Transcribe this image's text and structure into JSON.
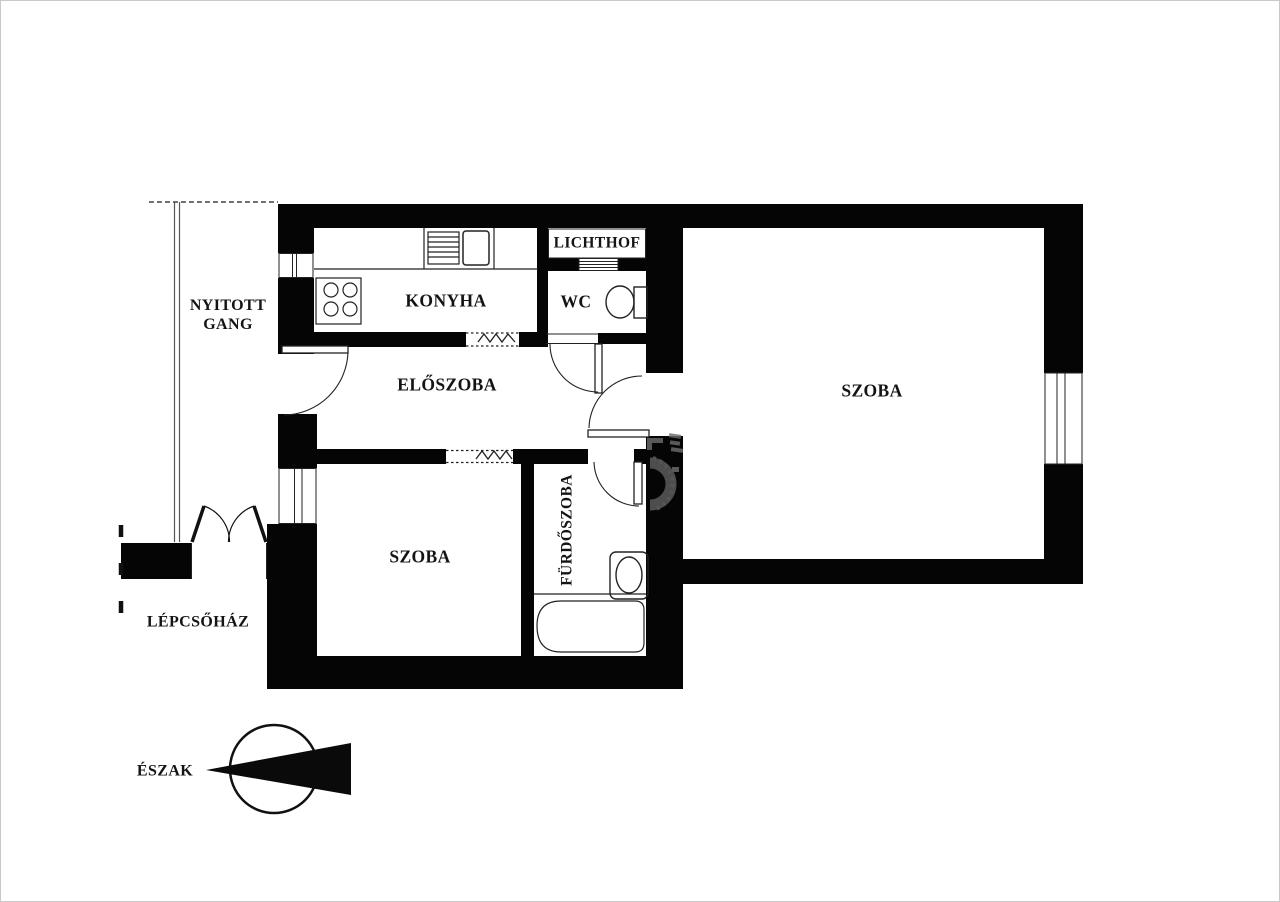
{
  "document": {
    "type": "apartment floor plan",
    "language": "hu"
  },
  "labels": {
    "nyitott_gang_line1": "NYITOTT",
    "nyitott_gang_line2": "GANG",
    "konyha": "KONYHA",
    "lichthof": "LICHTHOF",
    "wc": "WC",
    "eloszoba": "ELŐSZOBA",
    "szoba_right": "SZOBA",
    "szoba_left": "SZOBA",
    "furdoszoba": "FÜRDŐSZOBA",
    "lepcsohaz": "LÉPCSŐHÁZ",
    "eszak": "ÉSZAK"
  },
  "compass": {
    "label": "ÉSZAK",
    "arrow_points": "left"
  },
  "fixtures": [
    "stove-icon",
    "kitchen-sink-icon",
    "toilet-icon",
    "washbasin-icon",
    "bathtub-icon",
    "radiator-zigzag-icon",
    "lichthof-vent-icon"
  ],
  "colors": {
    "walls": "#050505",
    "background": "#ffffff",
    "thin_lines": "#222222",
    "gallery_lines": "#555555",
    "watermark": "#6e6e6e"
  }
}
